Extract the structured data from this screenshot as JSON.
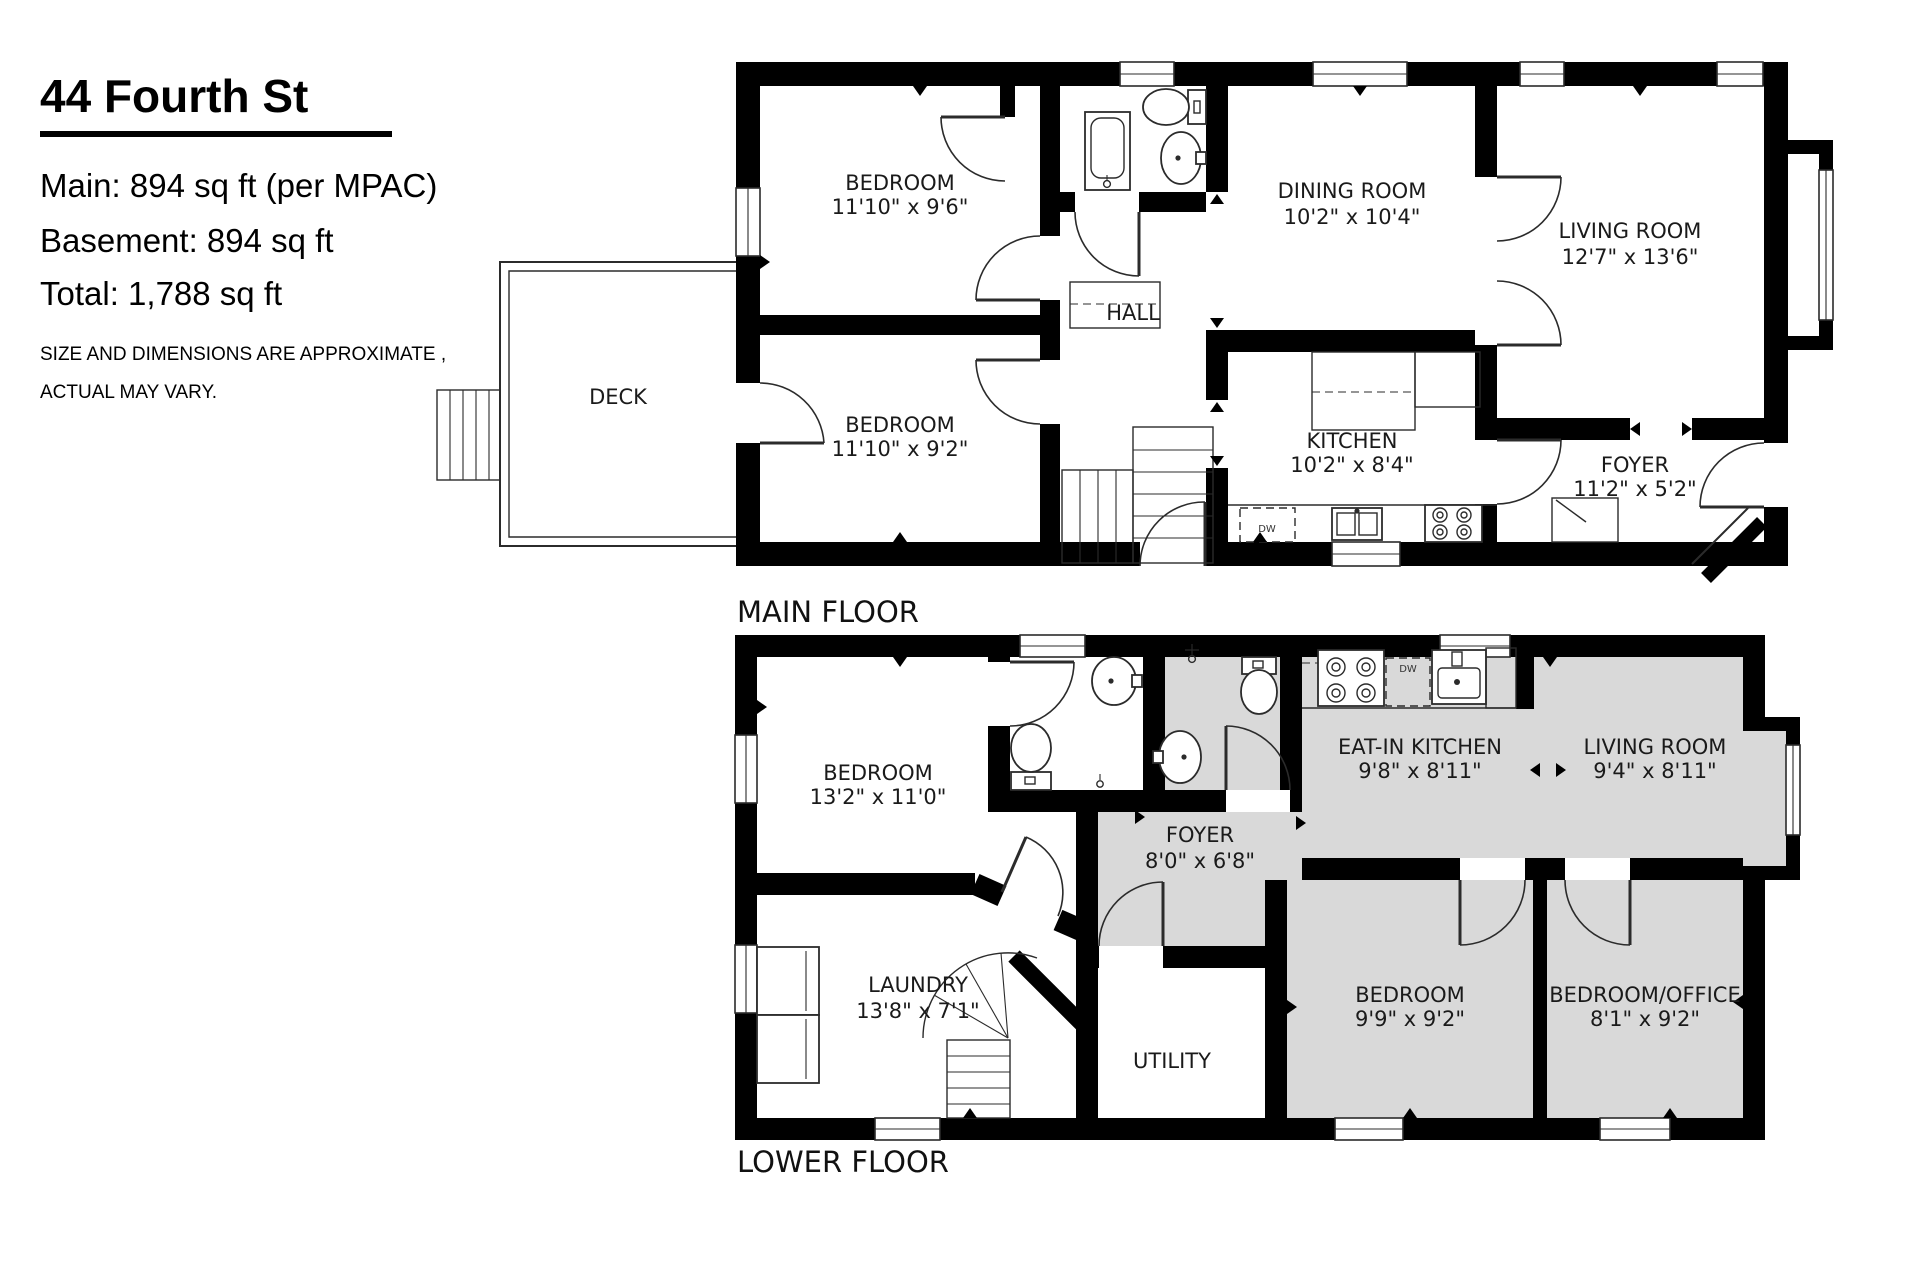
{
  "header": {
    "title": "44 Fourth St",
    "line1": "Main: 894 sq ft (per MPAC)",
    "line2": "Basement: 894 sq ft",
    "line3": "Total: 1,788 sq ft",
    "disclaimer1": "SIZE AND DIMENSIONS ARE APPROXIMATE ,",
    "disclaimer2": "ACTUAL MAY VARY."
  },
  "floors": {
    "main": {
      "label": "MAIN FLOOR",
      "rooms": {
        "bedroom1": {
          "name": "BEDROOM",
          "dims": "11'10\" x 9'6\""
        },
        "bedroom2": {
          "name": "BEDROOM",
          "dims": "11'10\" x 9'2\""
        },
        "hall": {
          "name": "HALL"
        },
        "dining": {
          "name": "DINING ROOM",
          "dims": "10'2\" x 10'4\""
        },
        "living": {
          "name": "LIVING ROOM",
          "dims": "12'7\" x 13'6\""
        },
        "kitchen": {
          "name": "KITCHEN",
          "dims": "10'2\" x 8'4\""
        },
        "foyer": {
          "name": "FOYER",
          "dims": "11'2\" x 5'2\""
        },
        "deck": {
          "name": "DECK"
        }
      },
      "appliances": {
        "dishwasher": "DW"
      }
    },
    "lower": {
      "label": "LOWER FLOOR",
      "rooms": {
        "bedroom": {
          "name": "BEDROOM",
          "dims": "13'2\" x 11'0\""
        },
        "eatin_kitchen": {
          "name": "EAT-IN KITCHEN",
          "dims": "9'8\" x 8'11\""
        },
        "living": {
          "name": "LIVING ROOM",
          "dims": "9'4\" x 8'11\""
        },
        "foyer": {
          "name": "FOYER",
          "dims": "8'0\" x 6'8\""
        },
        "laundry": {
          "name": "LAUNDRY",
          "dims": "13'8\" x 7'1\""
        },
        "utility": {
          "name": "UTILITY"
        },
        "bedroom2": {
          "name": "BEDROOM",
          "dims": "9'9\" x 9'2\""
        },
        "bedroom_office": {
          "name": "BEDROOM/OFFICE",
          "dims": "8'1\" x 9'2\""
        }
      },
      "appliances": {
        "dishwasher": "DW"
      }
    }
  },
  "colors": {
    "wall": "#000000",
    "suite_fill": "#d9d9d9",
    "line": "#2b2b2b"
  }
}
